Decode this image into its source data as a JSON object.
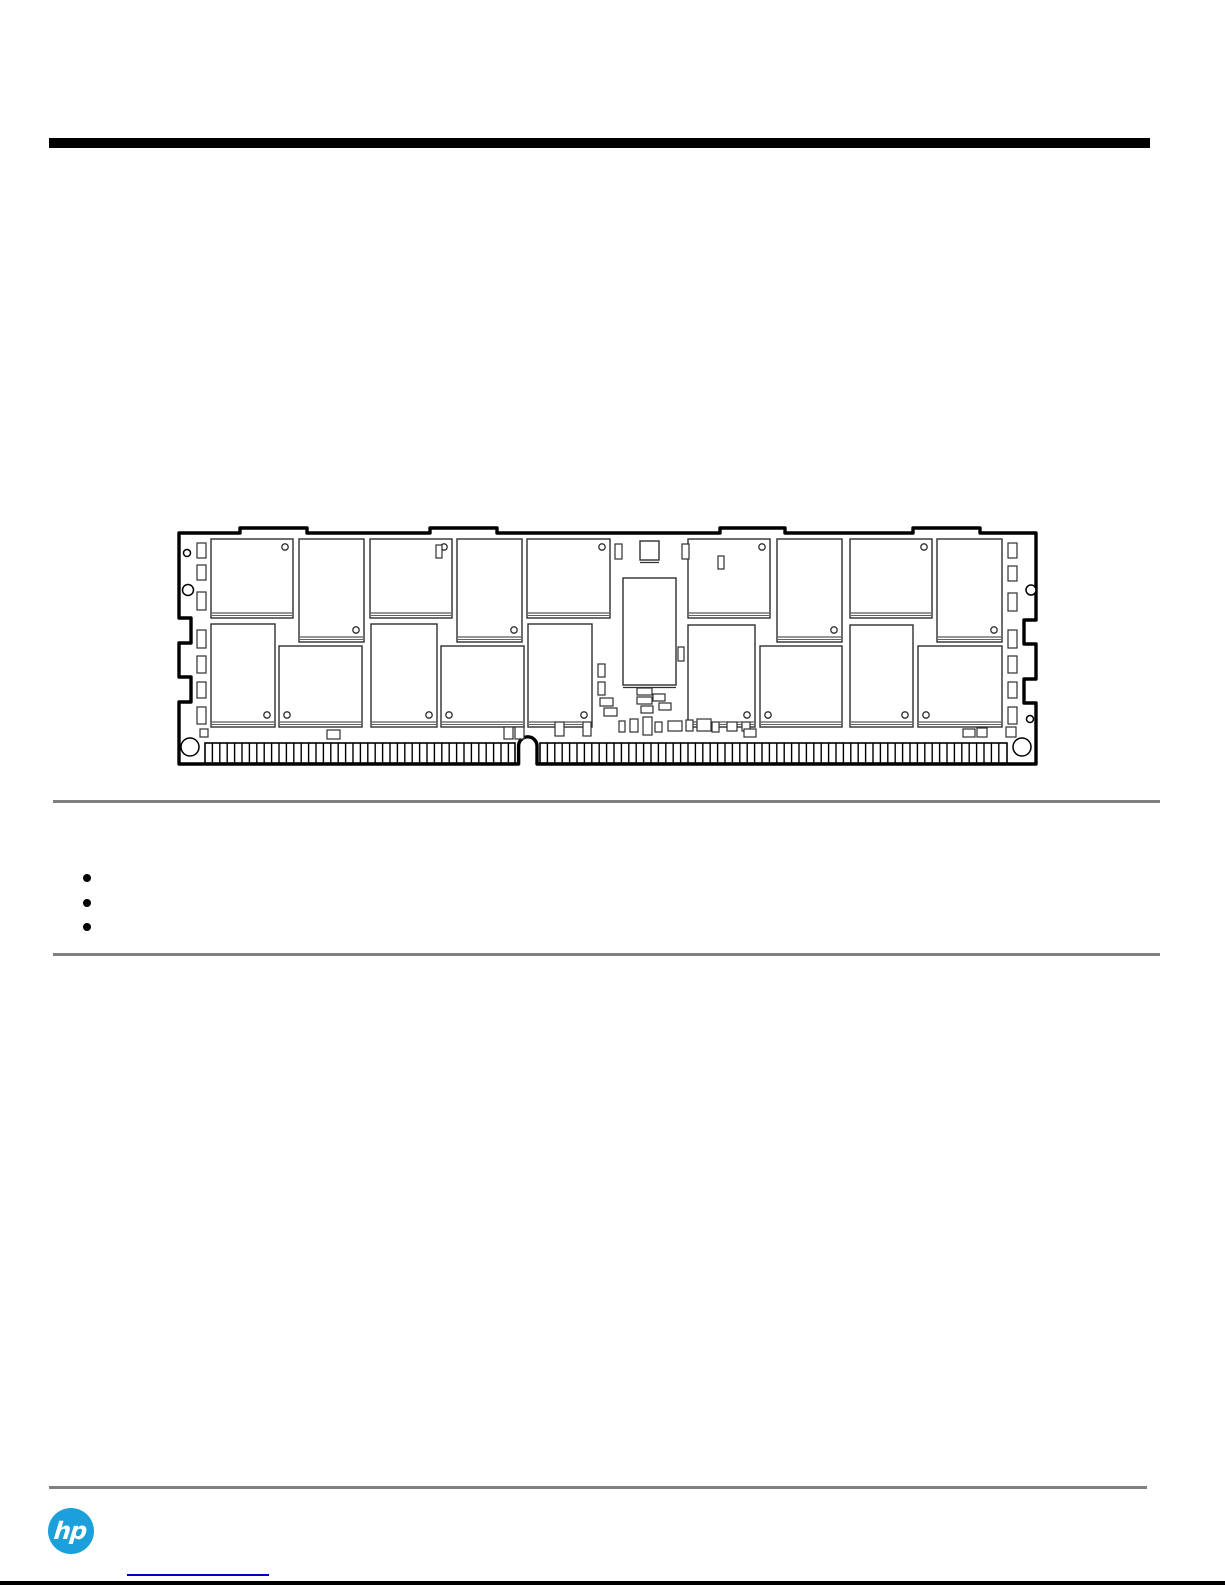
{
  "page": {
    "background": "#ffffff",
    "width": 1225,
    "height": 1585
  },
  "header": {
    "bar_color": "#000000"
  },
  "sections": {
    "divider_color": "#808080"
  },
  "bullet_list": {
    "bullet_color": "#000000",
    "items": [
      {
        "label": ""
      },
      {
        "label": ""
      },
      {
        "label": ""
      }
    ]
  },
  "footer": {
    "logo_text": "hp",
    "logo_color": "#1ca0dc",
    "link": {
      "label": "",
      "underline_color": "#0000cc"
    },
    "bottom_bar_color": "#000000"
  },
  "figure": {
    "title": "registered-dimm-memory-module-line-drawing",
    "colors": {
      "outline": "#000000",
      "detail": "#2f2f2f",
      "fill": "#ffffff"
    },
    "board_path": "M 179 533 H 240 V 528 H 307 V 533 H 430 V 528 H 497 V 533 H 720 V 528 H 785 V 533 H 913 V 528 H 980 V 533 H 1036 V 620 H 1024 V 644 H 1036 V 679 H 1024 V 703 H 1036 V 764 H 537 V 746 A 9.2 9.2 0 0 0 518.6 746 V 764 H 179 V 702 H 191 V 677 H 179 V 643 H 191 V 618 H 179 Z",
    "fingers": {
      "y_top": 743,
      "y_bottom": 763,
      "pitch": 7.4,
      "segments": [
        [
          205,
          515
        ],
        [
          540,
          1007
        ]
      ]
    },
    "chips": [
      [
        211,
        539,
        82,
        79,
        "tr"
      ],
      [
        299,
        539,
        65,
        103,
        "br"
      ],
      [
        370,
        539,
        82,
        79,
        "tr"
      ],
      [
        457,
        539,
        65,
        103,
        "br"
      ],
      [
        527,
        539,
        83,
        79,
        "tr"
      ],
      [
        688,
        539,
        82,
        79,
        "tr"
      ],
      [
        777,
        539,
        65,
        103,
        "br"
      ],
      [
        850,
        539,
        82,
        79,
        "tr"
      ],
      [
        937,
        539,
        65,
        103,
        "br"
      ],
      [
        211,
        624,
        64,
        103,
        "br"
      ],
      [
        279,
        646,
        83,
        81,
        "bl"
      ],
      [
        371,
        624,
        66,
        103,
        "br"
      ],
      [
        441,
        646,
        83,
        81,
        "bl"
      ],
      [
        528,
        624,
        64,
        103,
        "br"
      ],
      [
        688,
        625,
        67,
        102,
        "br"
      ],
      [
        760,
        646,
        82,
        81,
        "bl"
      ],
      [
        850,
        625,
        63,
        102,
        "br"
      ],
      [
        918,
        646,
        84,
        81,
        "bl"
      ]
    ],
    "blocks": [
      [
        640,
        541,
        19,
        19
      ],
      [
        623,
        578,
        53,
        107
      ]
    ],
    "passives": [
      [
        197,
        543,
        9,
        15
      ],
      [
        197,
        565,
        9,
        15
      ],
      [
        197,
        592,
        9,
        18
      ],
      [
        197,
        630,
        9,
        18
      ],
      [
        197,
        656,
        9,
        17
      ],
      [
        197,
        682,
        9,
        16
      ],
      [
        197,
        707,
        9,
        17
      ],
      [
        1008,
        543,
        9,
        15
      ],
      [
        1008,
        566,
        9,
        15
      ],
      [
        1008,
        593,
        9,
        18
      ],
      [
        1008,
        630,
        9,
        18
      ],
      [
        1008,
        656,
        9,
        17
      ],
      [
        1008,
        682,
        9,
        16
      ],
      [
        1008,
        707,
        9,
        17
      ],
      [
        615,
        544,
        7,
        15
      ],
      [
        682,
        544,
        7,
        15
      ],
      [
        436,
        545,
        6,
        13
      ],
      [
        718,
        556,
        6,
        13
      ],
      [
        678,
        647,
        6,
        14
      ],
      [
        598,
        664,
        7,
        13
      ],
      [
        598,
        682,
        7,
        13
      ],
      [
        600,
        698,
        13,
        8
      ],
      [
        604,
        708,
        13,
        8
      ],
      [
        637,
        688,
        15,
        7
      ],
      [
        637,
        697,
        15,
        7
      ],
      [
        653,
        694,
        12,
        7
      ],
      [
        659,
        703,
        12,
        7
      ],
      [
        641,
        706,
        12,
        7
      ],
      [
        619,
        721,
        6,
        11
      ],
      [
        630,
        719,
        8,
        13
      ],
      [
        643,
        717,
        9,
        18
      ],
      [
        655,
        722,
        7,
        10
      ],
      [
        668,
        721,
        14,
        10
      ],
      [
        686,
        720,
        7,
        11
      ],
      [
        697,
        719,
        14,
        12
      ],
      [
        712,
        722,
        7,
        10
      ],
      [
        727,
        722,
        10,
        9
      ],
      [
        742,
        722,
        8,
        9
      ],
      [
        200,
        729,
        8,
        8
      ],
      [
        327,
        730,
        13,
        9
      ],
      [
        504,
        727,
        9,
        12
      ],
      [
        515,
        727,
        9,
        12
      ],
      [
        555,
        722,
        9,
        14
      ],
      [
        583,
        722,
        8,
        14
      ],
      [
        744,
        729,
        12,
        8
      ],
      [
        963,
        729,
        12,
        8
      ],
      [
        977,
        728,
        10,
        9
      ],
      [
        1006,
        727,
        10,
        10
      ]
    ],
    "circles": [
      [
        190,
        747,
        9
      ],
      [
        1022,
        747,
        9
      ],
      [
        187,
        553,
        3.5
      ],
      [
        188,
        590,
        5.5
      ],
      [
        1031,
        590,
        5
      ],
      [
        1030,
        719,
        3.5
      ]
    ]
  }
}
